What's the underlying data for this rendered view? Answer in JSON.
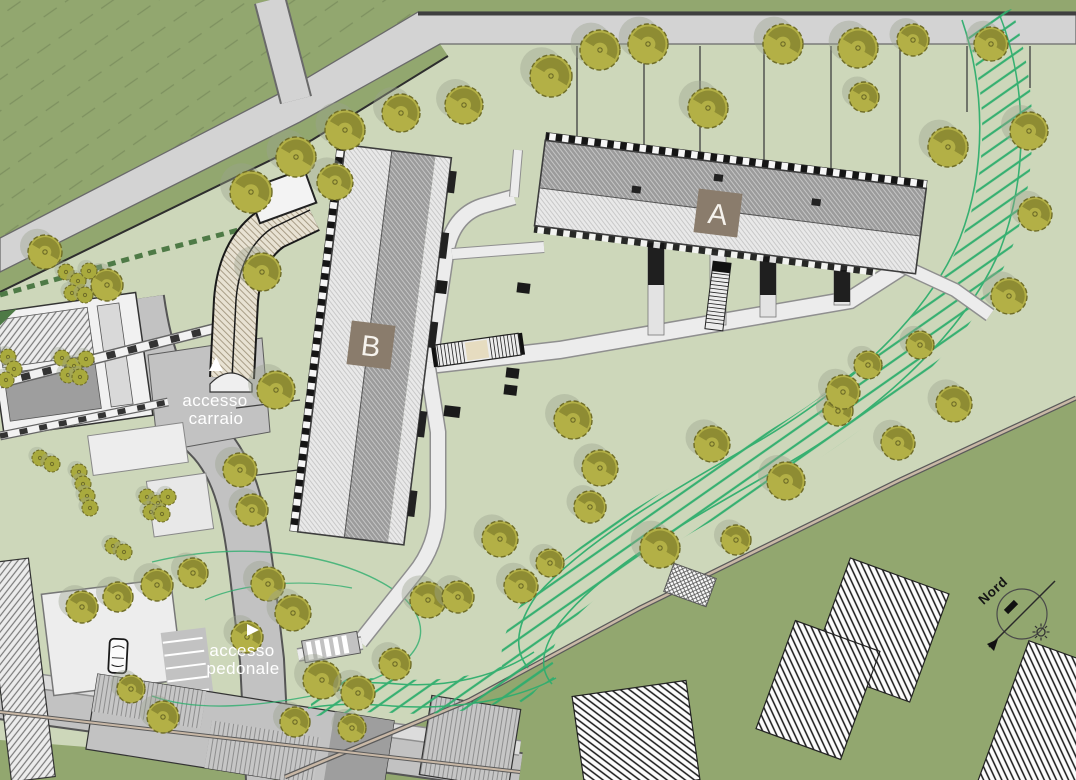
{
  "plan": {
    "labels": {
      "building_a": "A",
      "building_b": "B",
      "access_vehicle_line1": "accesso",
      "access_vehicle_line2": "carraio",
      "access_pedestrian_line1": "accesso",
      "access_pedestrian_line2": "pedonale",
      "north": "Nord"
    },
    "colors": {
      "terrain_outer": "#92a76f",
      "site_green": "#cdd7ba",
      "road_gray": "#d3d3d3",
      "road_dark": "#c2c2c2",
      "path_fill": "#ececec",
      "path_edge": "#8f8f8f",
      "tree_fill": "#b3b046",
      "tree_dark": "#8e8c33",
      "tree_edge": "#6f6d28",
      "tree_shadow": "#9aa38f",
      "bush_fill": "#a9aa3d",
      "label_bg": "#8a7c6c",
      "label_text": "#f6f3ed",
      "hatch_green": "#2fae6e",
      "ramp_beige": "#e8e2d3",
      "boundary_tan": "#c9b8a6",
      "access_text": "#ffffff",
      "hedge_green": "#4e7a46"
    },
    "trees": [
      [
        251,
        192,
        21
      ],
      [
        296,
        157,
        20
      ],
      [
        345,
        130,
        20
      ],
      [
        401,
        113,
        19
      ],
      [
        464,
        105,
        19
      ],
      [
        335,
        182,
        18
      ],
      [
        551,
        76,
        21
      ],
      [
        600,
        50,
        20
      ],
      [
        648,
        44,
        20
      ],
      [
        708,
        108,
        20
      ],
      [
        783,
        44,
        20
      ],
      [
        858,
        48,
        20
      ],
      [
        864,
        97,
        15
      ],
      [
        913,
        40,
        16
      ],
      [
        991,
        44,
        17
      ],
      [
        948,
        147,
        20
      ],
      [
        1029,
        131,
        19
      ],
      [
        1035,
        214,
        17
      ],
      [
        1009,
        296,
        18
      ],
      [
        954,
        404,
        18
      ],
      [
        898,
        443,
        17
      ],
      [
        838,
        411,
        15
      ],
      [
        920,
        345,
        14
      ],
      [
        45,
        252,
        17
      ],
      [
        107,
        285,
        16
      ],
      [
        262,
        272,
        19
      ],
      [
        276,
        390,
        19
      ],
      [
        240,
        470,
        17
      ],
      [
        252,
        510,
        16
      ],
      [
        268,
        584,
        17
      ],
      [
        573,
        420,
        19
      ],
      [
        600,
        468,
        18
      ],
      [
        590,
        507,
        16
      ],
      [
        660,
        548,
        20
      ],
      [
        712,
        444,
        18
      ],
      [
        736,
        540,
        15
      ],
      [
        786,
        481,
        19
      ],
      [
        843,
        392,
        17
      ],
      [
        868,
        365,
        14
      ],
      [
        293,
        613,
        18
      ],
      [
        322,
        680,
        19
      ],
      [
        358,
        693,
        17
      ],
      [
        395,
        664,
        16
      ],
      [
        428,
        600,
        18
      ],
      [
        458,
        597,
        16
      ],
      [
        500,
        539,
        18
      ],
      [
        521,
        586,
        17
      ],
      [
        550,
        563,
        14
      ],
      [
        295,
        722,
        15
      ],
      [
        352,
        728,
        14
      ],
      [
        82,
        607,
        16
      ],
      [
        118,
        597,
        15
      ],
      [
        157,
        585,
        16
      ],
      [
        193,
        573,
        15
      ],
      [
        247,
        637,
        16
      ],
      [
        163,
        717,
        16
      ],
      [
        131,
        689,
        14
      ]
    ],
    "bushes": [
      [
        66,
        272
      ],
      [
        78,
        281
      ],
      [
        89,
        271
      ],
      [
        72,
        293
      ],
      [
        85,
        295
      ],
      [
        62,
        358
      ],
      [
        74,
        366
      ],
      [
        86,
        359
      ],
      [
        68,
        375
      ],
      [
        80,
        377
      ],
      [
        147,
        497
      ],
      [
        158,
        503
      ],
      [
        168,
        497
      ],
      [
        151,
        512
      ],
      [
        162,
        514
      ],
      [
        79,
        472
      ],
      [
        83,
        484
      ],
      [
        87,
        496
      ],
      [
        90,
        508
      ],
      [
        8,
        357
      ],
      [
        14,
        369
      ],
      [
        6,
        380
      ],
      [
        113,
        546
      ],
      [
        124,
        552
      ],
      [
        40,
        458
      ],
      [
        52,
        464
      ]
    ]
  }
}
